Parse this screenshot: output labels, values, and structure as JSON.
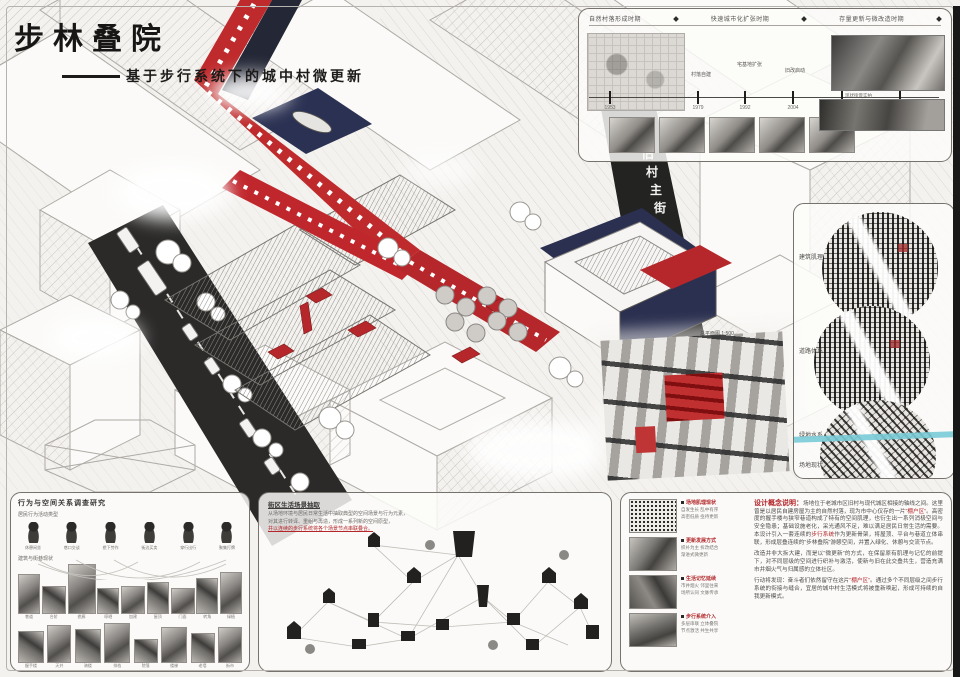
{
  "illustration": {
    "street_label": "旧村主街",
    "plan_label": "总平面图 1:500"
  },
  "title": {
    "main": "步林叠院",
    "subtitle": "基于步行系统下的城中村微更新"
  },
  "timeline": {
    "headers": [
      "自然村落形成时期",
      "快速城市化扩张时期",
      "存量更新与微改造时期"
    ],
    "events": [
      "村落自建",
      "宅基地扩张",
      "旧改启动",
      "微更新试点"
    ],
    "years": [
      "1953",
      "1979",
      "1992",
      "2004",
      "2015",
      "2020"
    ],
    "photo_note": "现状街景实拍"
  },
  "maps": {
    "labels": [
      "建筑肌理",
      "道路体系",
      "绿地水系",
      "场地现状"
    ]
  },
  "behavior": {
    "title": "行为与空间关系调查研究",
    "row1_label": "居民行为活动类型",
    "figures": [
      "休憩闲坐",
      "巷口交谈",
      "檐下劳作",
      "街边买卖",
      "穿行出行",
      "聚集打牌"
    ],
    "row2_label": "建筑与街巷现状",
    "row1_captions": [
      "巷道",
      "台阶",
      "檐廊",
      "晾晒",
      "加建",
      "屋顶",
      "门面",
      "转角",
      "绿植"
    ],
    "row2_captions": [
      "握手楼",
      "天井",
      "骑楼",
      "排档",
      "院落",
      "楼梯",
      "老墙",
      "街市"
    ]
  },
  "elements": {
    "title": "街区生活场景抽取",
    "line1": "从场地环境与居民日常生活中抽取典型的空间场景与行为元素，",
    "line2": "对其进行转译、重组与再造，形成一系列新的空间原型，",
    "line3": "并以连续的步行系统将各个场景节点串联叠合。"
  },
  "concept": {
    "bullets": [
      {
        "head": "场地肌理现状",
        "s1": "自发生长 乱中有序",
        "s2": "高密低质 亟待更新"
      },
      {
        "head": "更新发展方式",
        "s1": "织补为主 拆改结合",
        "s2": "渐进式微更新"
      },
      {
        "head": "生活记忆延续",
        "s1": "市井烟火 邻里往来",
        "s2": "场所认同 文脉传承"
      },
      {
        "head": "步行系统介入",
        "s1": "多层串联 立体叠院",
        "s2": "节点激活 共生共享"
      }
    ],
    "lead": "设计概念说明：",
    "p1a": "场地位于老城市区旧村与现代城区相接的轴线之间。这里曾是以居民自建房屋为主的自然村落，现为市中心仅存的一片",
    "p1b": "“棚户区”",
    "p1c": "。高密度的握手楼与狭窄巷道构成了特有的空间肌理，也衍生出一系列消极空间与安全隐患；基础设施老化，采光通风不足，难以满足居民日常生活的需要。本设计引入一套连续的",
    "p1d": "步行系统",
    "p1e": "作为更新骨架，将屋顶、平台与巷道立体串联，形成层叠连续的“步林叠院”游憩空间，并置入绿化、休憩与交流节点。",
    "p2": "改造并非大拆大建，而是以“微更新”的方式，在保留原有肌理与记忆的前提下，对不同层级的空间进行织补与激活，使新与旧在此交叠共生，营造充满市井烟火气与归属感的立体社区。",
    "p3a": "行动将发现：奋斗者们依然留守在这片",
    "p3b": "“棚户区”",
    "p3c": "。通过多个不同层级之间步行系统的衔接与缝合，宜居的城中村生活模式将被重新唤起，形成可持续的自我更新模式。"
  }
}
